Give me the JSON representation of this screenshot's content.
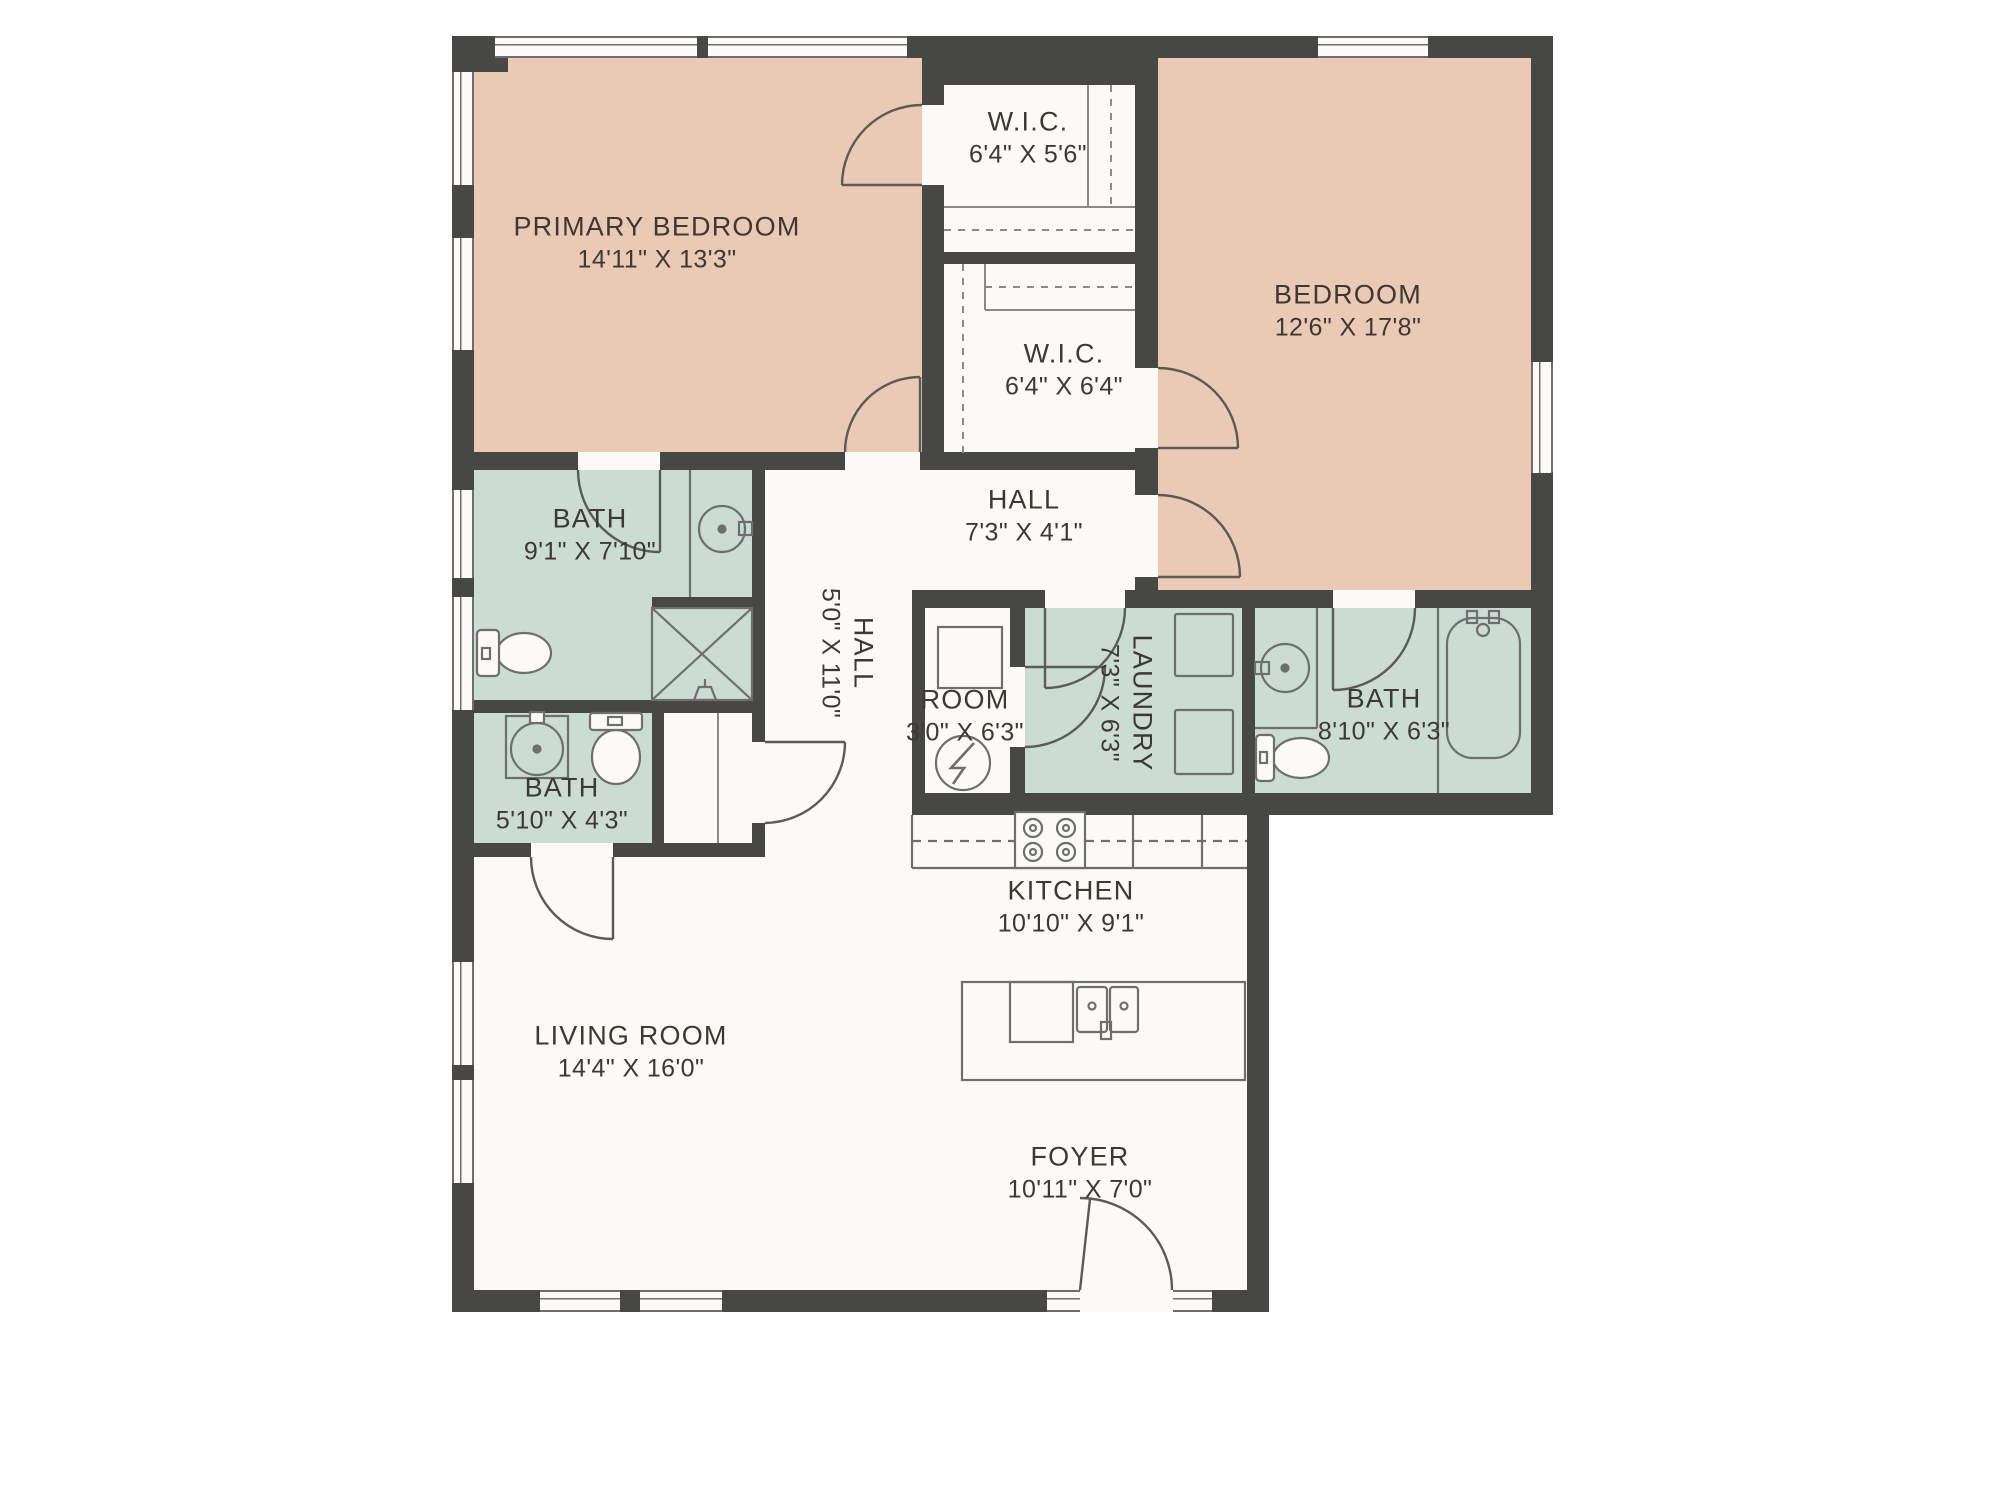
{
  "plan": {
    "colors": {
      "bedroom_fill": "#ebcab5",
      "bath_fill": "#cbdcd4",
      "wall": "#474745",
      "floor": "#fbfaf7",
      "line": "#6e6e6e",
      "text": "#3d3833"
    },
    "rooms": [
      {
        "id": "primary-bedroom",
        "name": "PRIMARY BEDROOM",
        "dims": "14'11\" X 13'3\""
      },
      {
        "id": "wic-1",
        "name": "W.I.C.",
        "dims": "6'4\" X 5'6\""
      },
      {
        "id": "bedroom",
        "name": "BEDROOM",
        "dims": "12'6\" X 17'8\""
      },
      {
        "id": "wic-2",
        "name": "W.I.C.",
        "dims": "6'4\" X 6'4\""
      },
      {
        "id": "bath-primary",
        "name": "BATH",
        "dims": "9'1\" X 7'10\""
      },
      {
        "id": "hall",
        "name": "HALL",
        "dims": "7'3\" X 4'1\""
      },
      {
        "id": "hall-long",
        "name": "HALL",
        "dims": "5'0\" X 11'0\""
      },
      {
        "id": "room",
        "name": "ROOM",
        "dims": "3'0\" X 6'3\""
      },
      {
        "id": "laundry",
        "name": "LAUNDRY",
        "dims": "7'3\" X 6'3\""
      },
      {
        "id": "bath-hall",
        "name": "BATH",
        "dims": "8'10\" X 6'3\""
      },
      {
        "id": "bath-small",
        "name": "BATH",
        "dims": "5'10\" X 4'3\""
      },
      {
        "id": "kitchen",
        "name": "KITCHEN",
        "dims": "10'10\" X 9'1\""
      },
      {
        "id": "living-room",
        "name": "LIVING ROOM",
        "dims": "14'4\" X 16'0\""
      },
      {
        "id": "foyer",
        "name": "FOYER",
        "dims": "10'11\" X 7'0\""
      }
    ]
  }
}
